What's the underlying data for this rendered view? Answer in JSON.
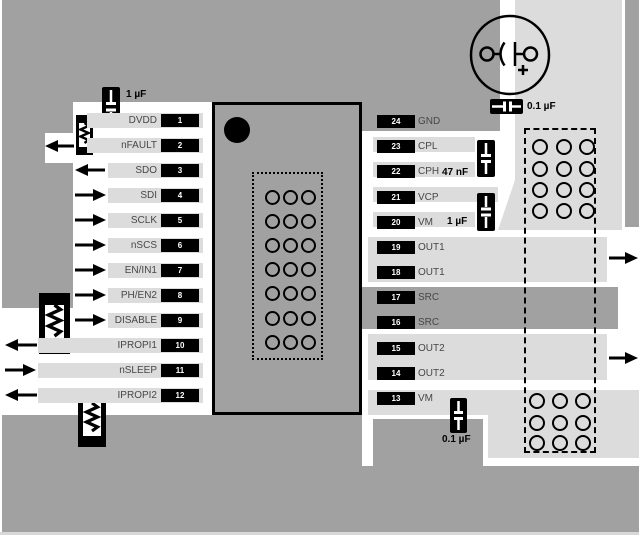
{
  "left_pins": [
    {
      "num": "1",
      "label": "DVDD",
      "arrow": "none"
    },
    {
      "num": "2",
      "label": "nFAULT",
      "arrow": "left"
    },
    {
      "num": "3",
      "label": "SDO",
      "arrow": "left"
    },
    {
      "num": "4",
      "label": "SDI",
      "arrow": "right"
    },
    {
      "num": "5",
      "label": "SCLK",
      "arrow": "right"
    },
    {
      "num": "6",
      "label": "nSCS",
      "arrow": "right"
    },
    {
      "num": "7",
      "label": "EN/IN1",
      "arrow": "right"
    },
    {
      "num": "8",
      "label": "PH/EN2",
      "arrow": "right"
    },
    {
      "num": "9",
      "label": "DISABLE",
      "arrow": "right"
    },
    {
      "num": "10",
      "label": "IPROPI1",
      "arrow": "left"
    },
    {
      "num": "11",
      "label": "nSLEEP",
      "arrow": "right"
    },
    {
      "num": "12",
      "label": "IPROPI2",
      "arrow": "left"
    }
  ],
  "right_pins": [
    {
      "num": "24",
      "label": "GND",
      "arrow": "none"
    },
    {
      "num": "23",
      "label": "CPL",
      "arrow": "none"
    },
    {
      "num": "22",
      "label": "CPH",
      "arrow": "none"
    },
    {
      "num": "21",
      "label": "VCP",
      "arrow": "none"
    },
    {
      "num": "20",
      "label": "VM",
      "arrow": "none"
    },
    {
      "num": "19",
      "label": "OUT1",
      "arrow": "right-out"
    },
    {
      "num": "18",
      "label": "OUT1",
      "arrow": "none"
    },
    {
      "num": "17",
      "label": "SRC",
      "arrow": "none"
    },
    {
      "num": "16",
      "label": "SRC",
      "arrow": "none"
    },
    {
      "num": "15",
      "label": "OUT2",
      "arrow": "right-out"
    },
    {
      "num": "14",
      "label": "OUT2",
      "arrow": "none"
    },
    {
      "num": "13",
      "label": "VM",
      "arrow": "none"
    }
  ],
  "component_labels": {
    "cap_dvdd": "1 µF",
    "cap_bulk_bypass": "0.1 µF",
    "cap_flying": "47 nF",
    "cap_vcp": "1 µF",
    "cap_vm_bypass": "0.1 µF"
  },
  "colors": {
    "ground_plane": "#a1a1a1",
    "copper_pour": "#dcdcdc",
    "route_area": "#ffffff",
    "component": "#000000",
    "pin_label": "#474747"
  }
}
